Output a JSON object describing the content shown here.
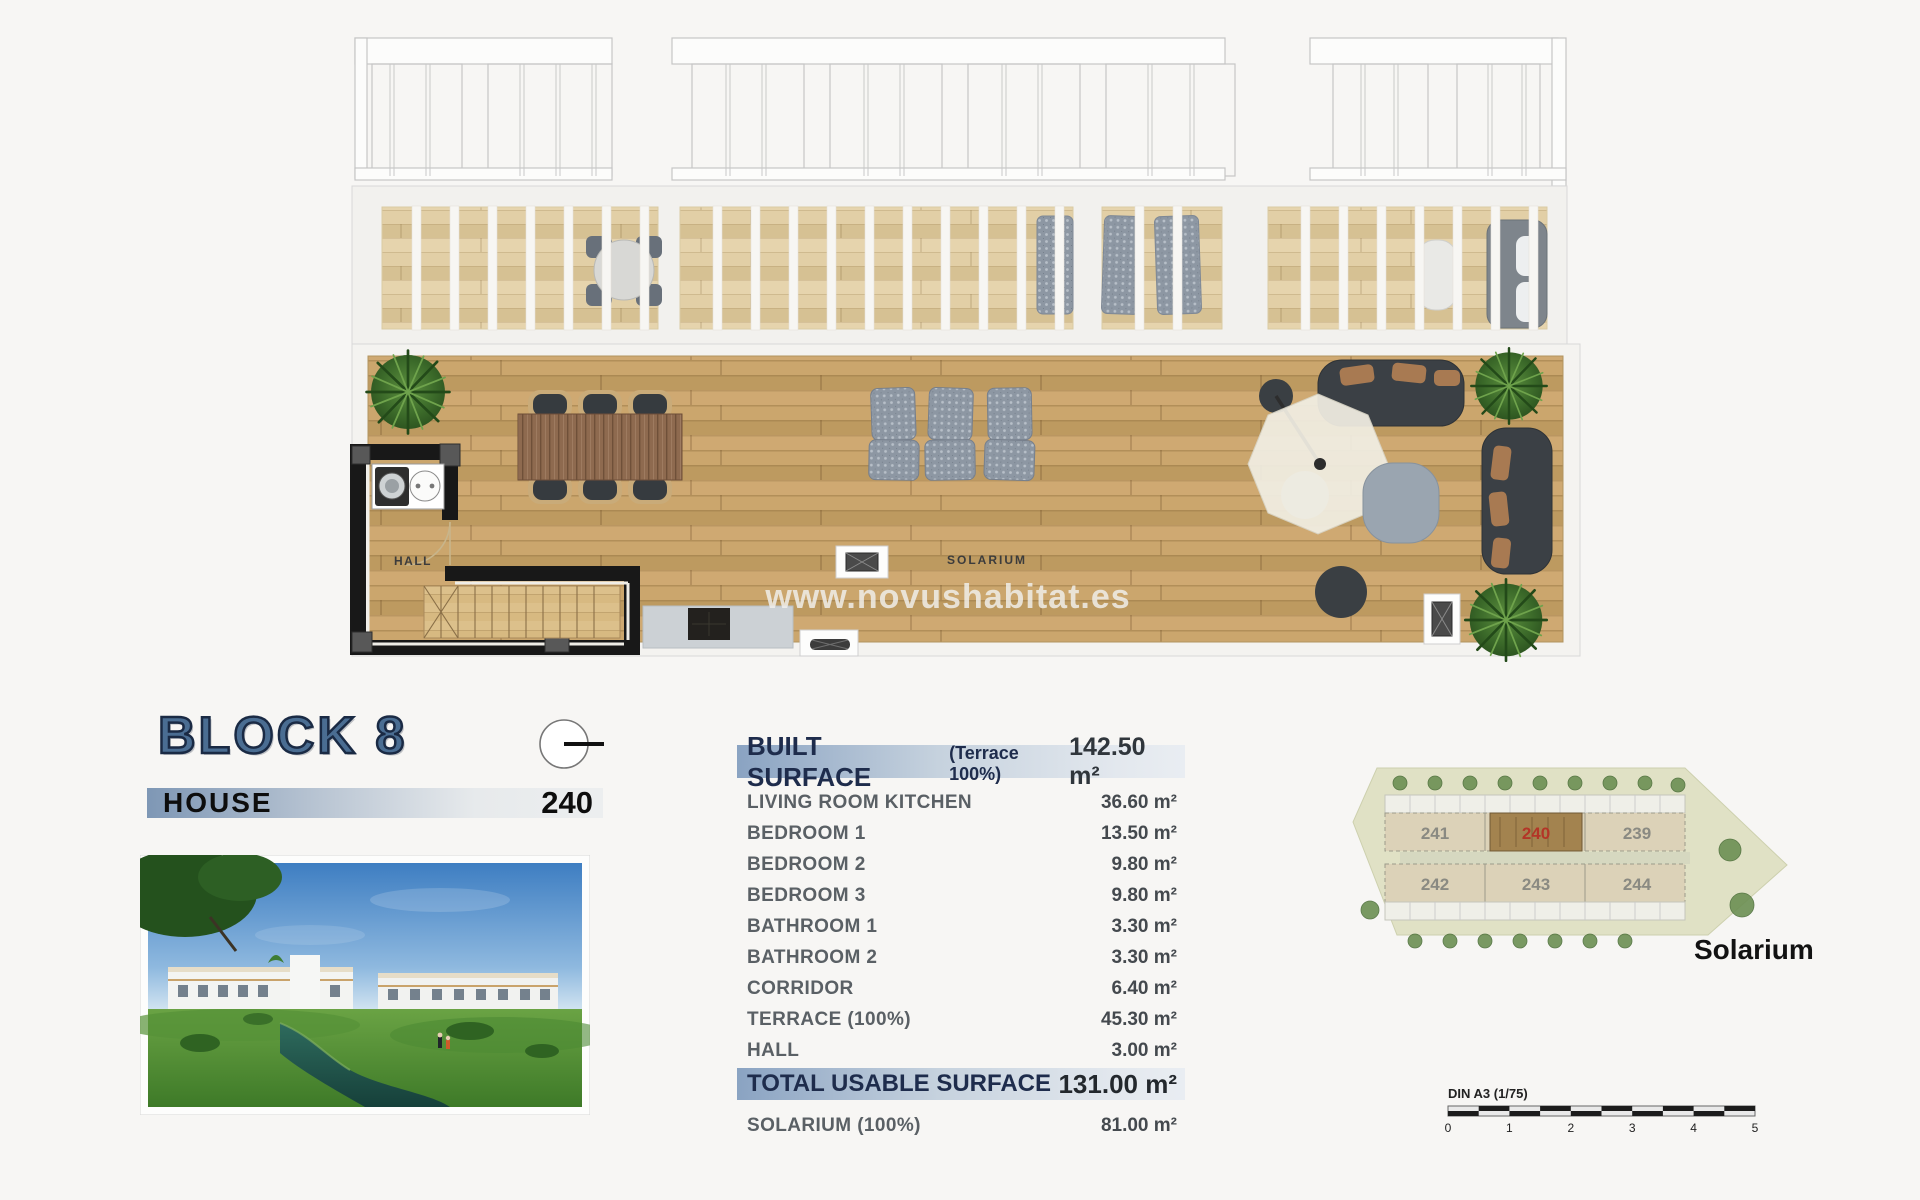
{
  "page": {
    "watermark": "www.novushabitat.es",
    "title_block": {
      "block_title": "BLOCK 8",
      "house_label": "HOUSE",
      "house_number": "240"
    },
    "floor_plan": {
      "hall_label": "HALL",
      "solarium_label": "SOLARIUM"
    },
    "surface_table": {
      "header": {
        "label": "BUILT SURFACE",
        "note": "(Terrace 100%)",
        "value": "142.50 m²"
      },
      "rows": [
        {
          "label": "LIVING ROOM KITCHEN",
          "value": "36.60 m²"
        },
        {
          "label": "BEDROOM 1",
          "value": "13.50 m²"
        },
        {
          "label": "BEDROOM 2",
          "value": "9.80 m²"
        },
        {
          "label": "BEDROOM 3",
          "value": "9.80 m²"
        },
        {
          "label": "BATHROOM 1",
          "value": "3.30 m²"
        },
        {
          "label": "BATHROOM 2",
          "value": "3.30 m²"
        },
        {
          "label": "CORRIDOR",
          "value": "6.40 m²"
        },
        {
          "label": "TERRACE (100%)",
          "value": "45.30 m²"
        },
        {
          "label": "HALL",
          "value": "3.00 m²"
        }
      ],
      "total": {
        "label": "TOTAL USABLE SURFACE",
        "value": "131.00 m²"
      },
      "solarium_row": {
        "label": "SOLARIUM (100%)",
        "value": "81.00 m²"
      }
    },
    "site_plan": {
      "caption": "Solarium",
      "units_top": [
        "241",
        "240",
        "239"
      ],
      "units_bottom": [
        "242",
        "243",
        "244"
      ],
      "highlighted_unit": "240"
    },
    "scale_bar": {
      "label": "DIN A3 (1/75)",
      "ticks": [
        "0",
        "1",
        "2",
        "3",
        "4",
        "5"
      ]
    },
    "colors": {
      "accent_blue": "#7e97b5",
      "header_navy": "#1e2c4c",
      "highlight_red": "#b33527"
    }
  }
}
